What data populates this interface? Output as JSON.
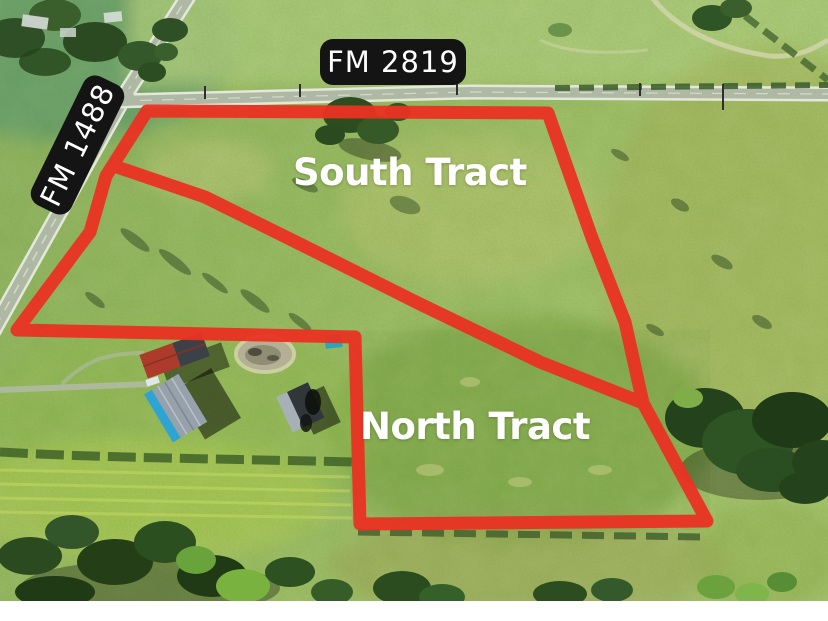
{
  "labels": {
    "road_2819": "FM 2819",
    "road_1488": "FM 1488",
    "south_tract": "South Tract",
    "north_tract": "North Tract"
  },
  "colors": {
    "boundary_red": "#ea3222",
    "road_label_bg": "#141414",
    "road_label_text": "#ffffff",
    "tract_label_text": "#ffffff",
    "bottom_bar": "#ffffff"
  }
}
